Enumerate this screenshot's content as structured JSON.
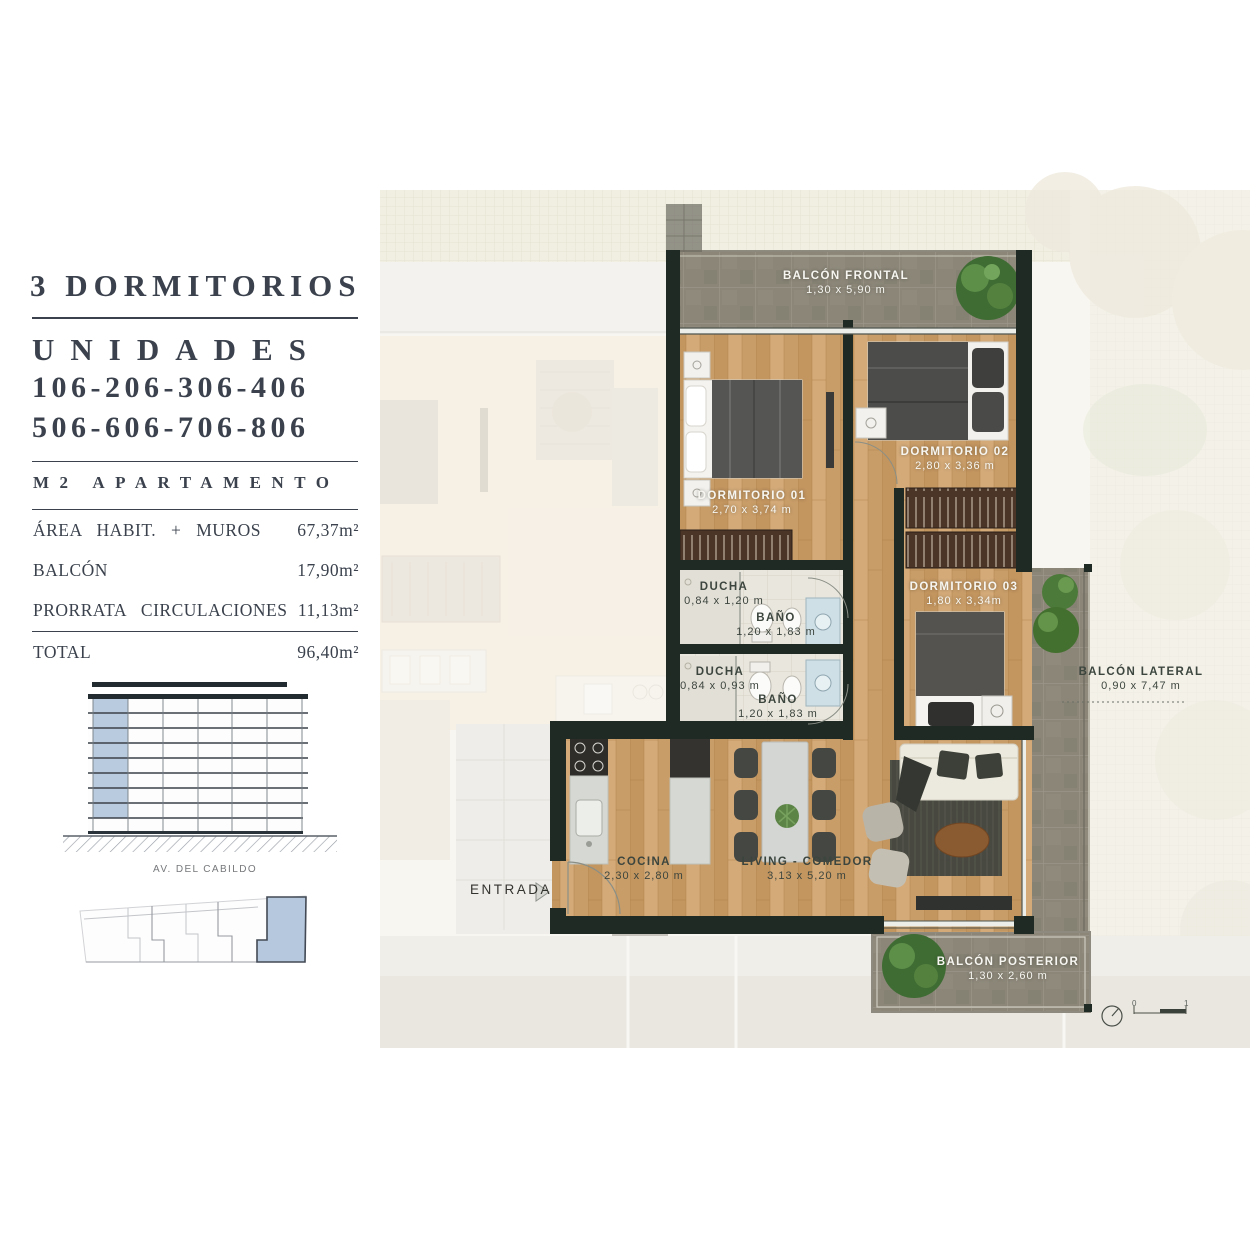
{
  "panel": {
    "title": "3 DORMITORIOS",
    "subtitle": "UNIDADES",
    "units_line1": "106-206-306-406",
    "units_line2": "506-606-706-806",
    "table_header": "M2 APARTAMENTO",
    "rows": [
      {
        "label": "ÁREA HABIT. + MUROS",
        "value": "67,37m²"
      },
      {
        "label": "BALCÓN",
        "value": "17,90m²"
      },
      {
        "label": "PRORRATA CIRCULACIONES",
        "value": "11,13m²"
      }
    ],
    "total": {
      "label": "TOTAL",
      "value": "96,40m²"
    },
    "street": "AV. DEL CABILDO"
  },
  "plan": {
    "entrance_label": "ENTRADA",
    "rooms": [
      {
        "name": "BALCÓN FRONTAL",
        "dims": "1,30 x 5,90 m"
      },
      {
        "name": "DORMITORIO 01",
        "dims": "2,70 x 3,74 m"
      },
      {
        "name": "DORMITORIO 02",
        "dims": "2,80 x 3,36 m"
      },
      {
        "name": "DORMITORIO 03",
        "dims": "1,80 x 3,34m"
      },
      {
        "name": "DUCHA",
        "dims": "0,84 x 1,20 m"
      },
      {
        "name": "BAÑO",
        "dims": "1,20 x 1,83 m"
      },
      {
        "name": "DUCHA",
        "dims": "0,84 x 0,93 m"
      },
      {
        "name": "BAÑO",
        "dims": "1,20 x 1,83 m"
      },
      {
        "name": "COCINA",
        "dims": "2,30 x 2,80 m"
      },
      {
        "name": "LIVING - COMEDOR",
        "dims": "3,13 x 5,20 m"
      },
      {
        "name": "BALCÓN LATERAL",
        "dims": "0,90 x 7,47 m"
      },
      {
        "name": "BALCÓN POSTERIOR",
        "dims": "1,30 x 2,60 m"
      }
    ],
    "scale_bar": {
      "start": "0",
      "end": "1"
    }
  },
  "colors": {
    "wall": "#1f2a24",
    "wood_floor": "#cda26f",
    "stone": "#8b8678",
    "unit_highlight": "#b5c8dd",
    "text_dark": "#3b424d"
  }
}
